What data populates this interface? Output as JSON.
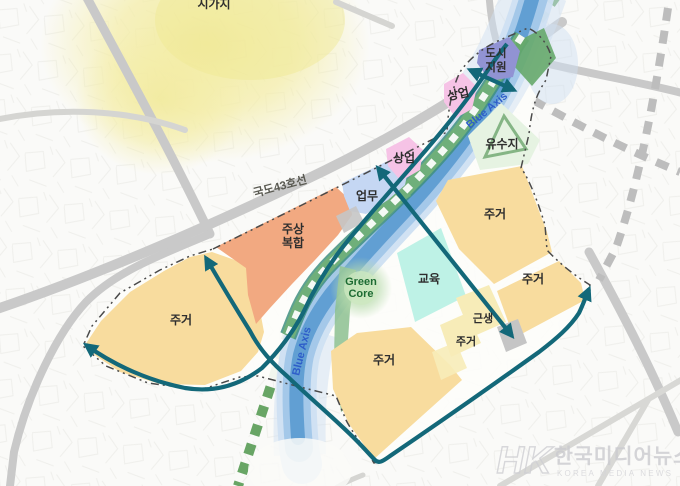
{
  "map": {
    "labels": {
      "urban_area": "시가지",
      "road": "국도43호선"
    },
    "zones": {
      "urban_support_l1": "도시",
      "urban_support_l2": "지원",
      "commercial": "상업",
      "detention": "유수지",
      "business": "업무",
      "mixed_l1": "주상",
      "mixed_l2": "복합",
      "residential": "주거",
      "education": "교육",
      "neighborhood": "근생"
    },
    "axis": {
      "blue": "Blue Axis",
      "green_core_l1": "Green",
      "green_core_l2": "Core"
    },
    "colors": {
      "residential": "#f8dc9e",
      "residential_pale": "#f7ecb8",
      "mixed_use": "#f2a981",
      "business": "#c5d7f3",
      "commercial": "#f6c3e6",
      "urban_support": "#9193d3",
      "education": "#bef2e6",
      "detention": "#e6f3e2",
      "detention_ring": "#85b585",
      "river_core": "#5b9bd0",
      "river_mid": "#9fc6e8",
      "river_edge": "#cfe0f2",
      "green_band": "#6faf7a",
      "green_band_edge": "#3f8f7f",
      "green_wedge": "#8cc08f",
      "teal": "#136879",
      "green_axis": "#68a565",
      "gray_axis": "#bdbdbd",
      "road": "#c9c9c9",
      "boundary": "#4a4a4a",
      "urban_area_tint": "#f3eda2",
      "blue_axis_text": "#2e5ec9",
      "green_core_text": "#1d6b33",
      "gray_patch": "#c5c5c5",
      "label_text": "#2e2e2e"
    }
  },
  "watermark": {
    "logo": "HK",
    "name": "한국미디어뉴스",
    "subtitle": "KOREA MEDIA NEWS"
  }
}
